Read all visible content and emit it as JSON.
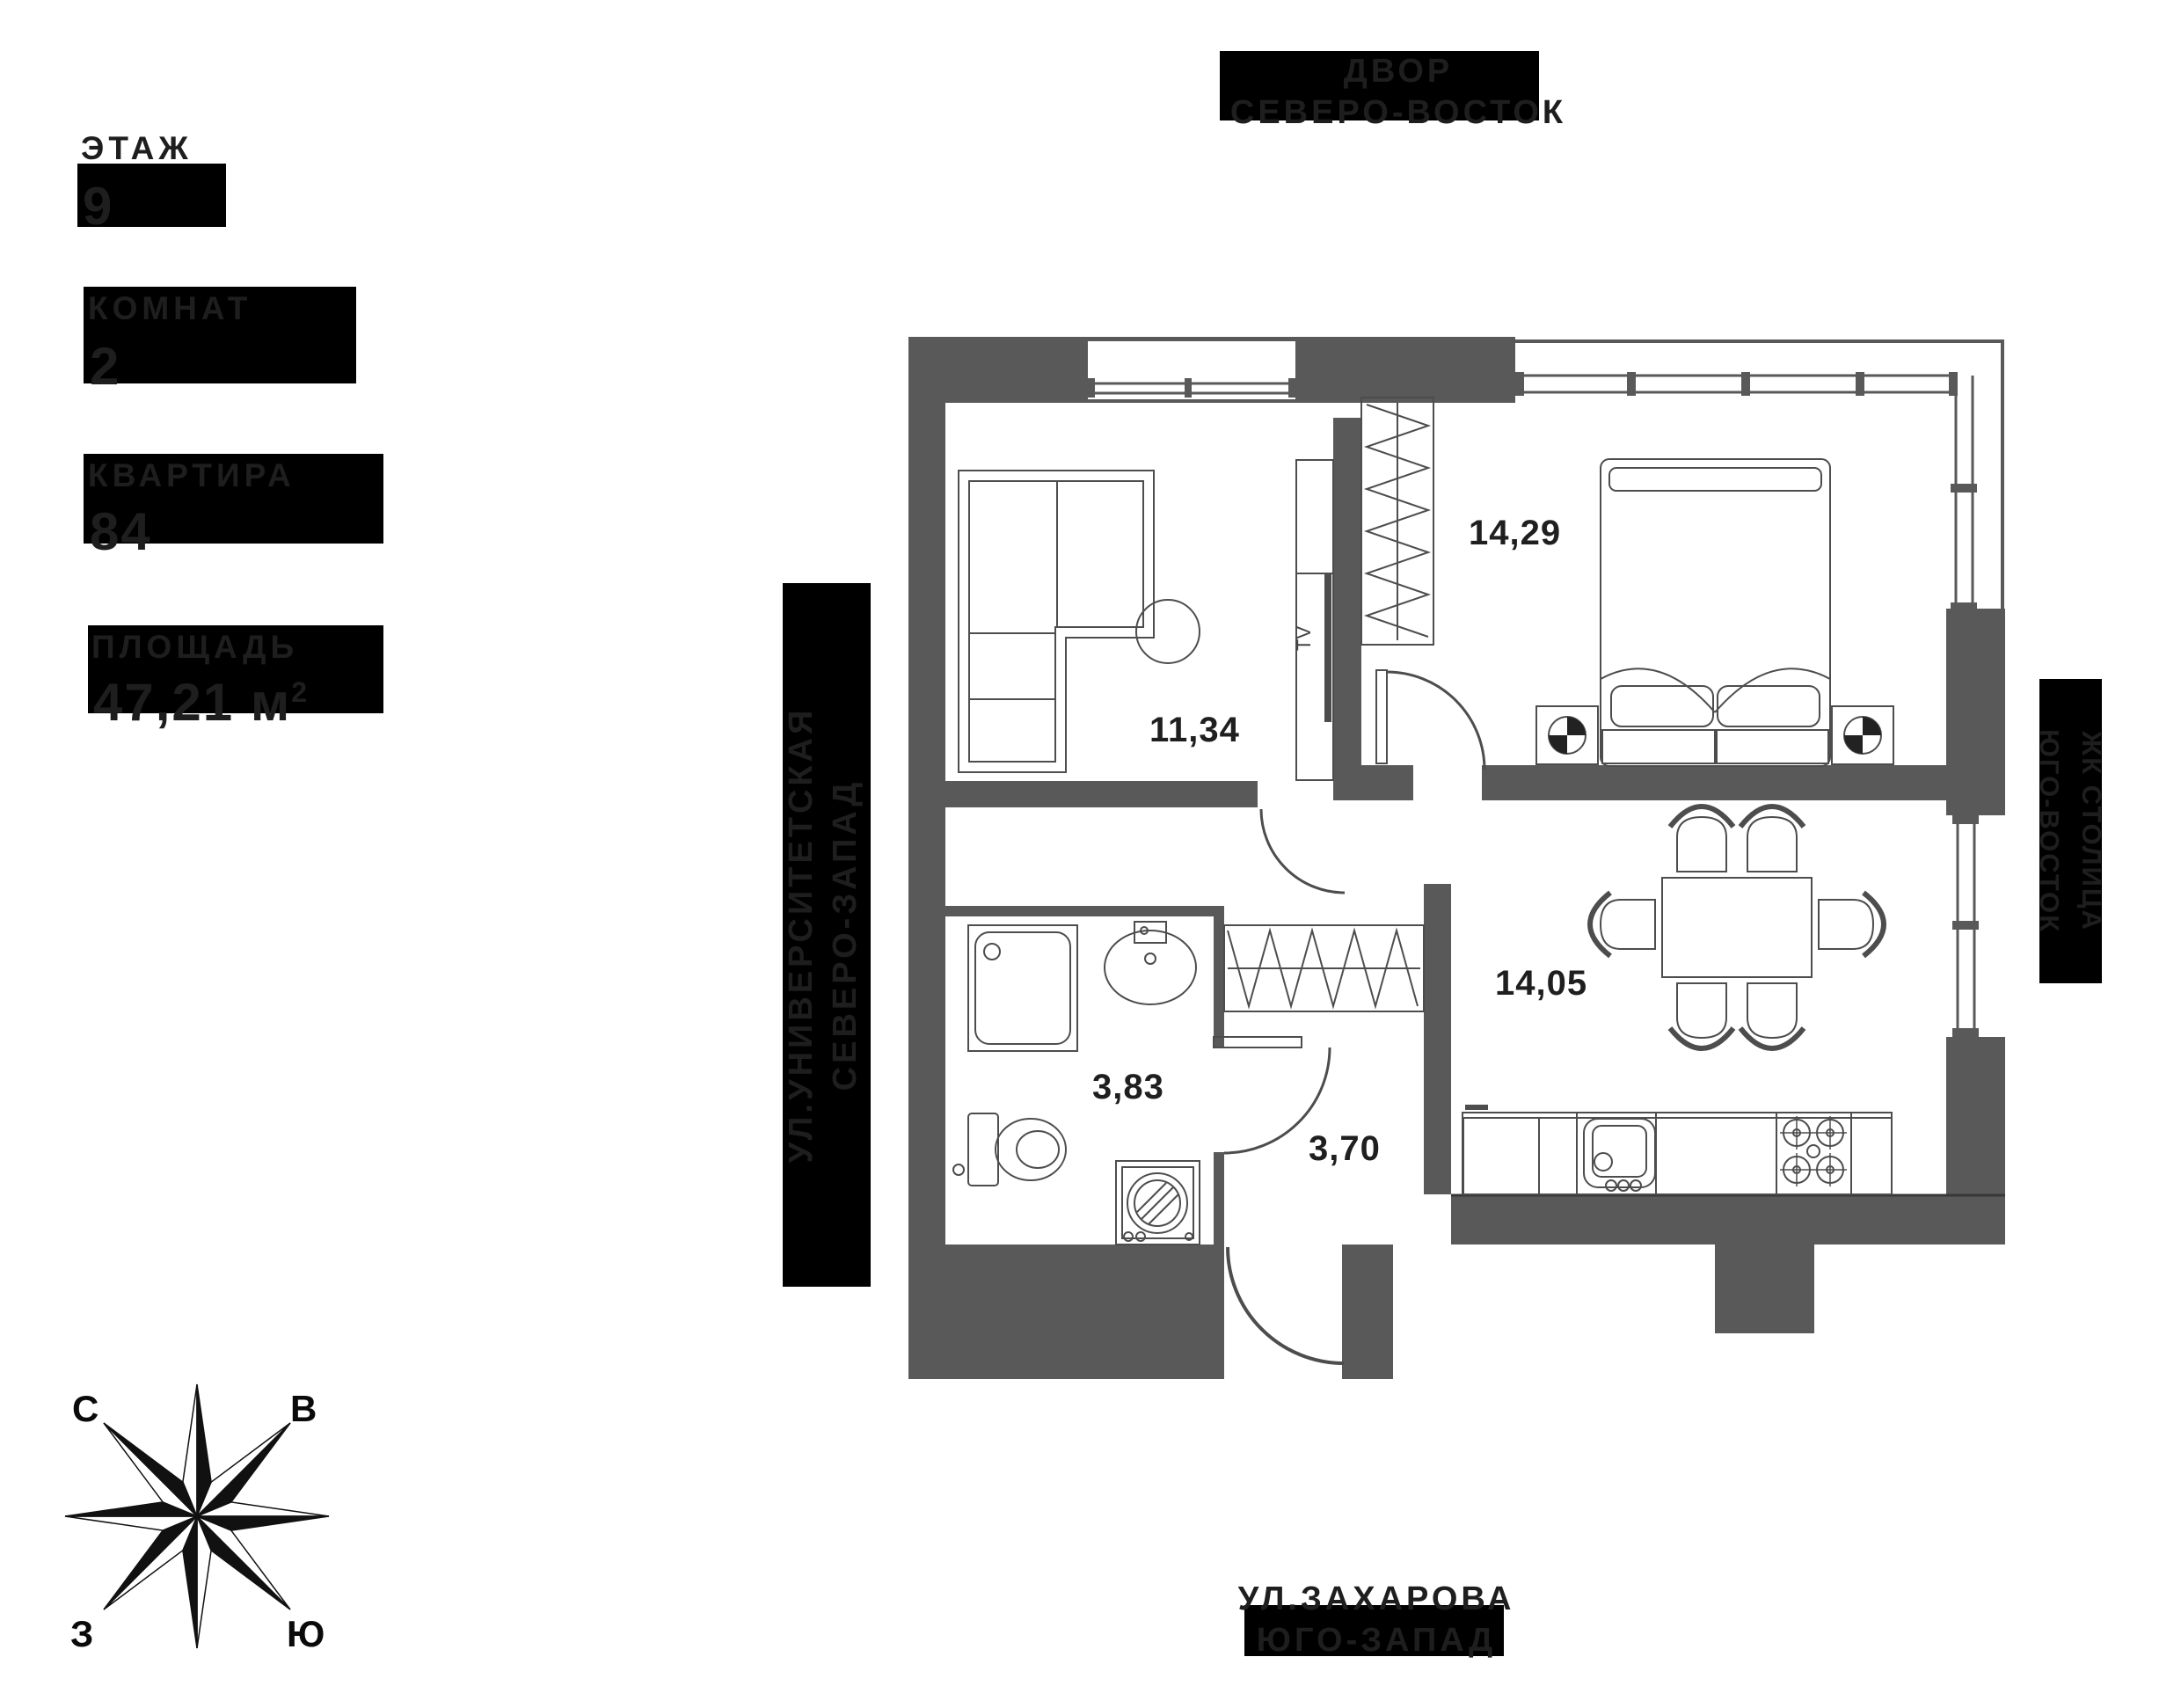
{
  "info_panel": {
    "items": [
      {
        "label": "ЭТАЖ",
        "value": "9"
      },
      {
        "label": "КОМНАТ",
        "value": "2"
      },
      {
        "label": "КВАРТИРА",
        "value": "84"
      },
      {
        "label": "ПЛОЩАДЬ",
        "value": "47,21 м",
        "sup": "2"
      }
    ]
  },
  "direction_labels": {
    "top": {
      "line1": "ДВОР",
      "line2": "СЕВЕРО-ВОСТОК"
    },
    "left": {
      "line1": "УЛ.УНИВЕРСИТЕТСКАЯ",
      "line2": "СЕВЕРО-ЗАПАД"
    },
    "right": {
      "line1": "ЖК СТОЛИЦА",
      "line2": "ЮГО-ВОСТОК"
    },
    "bottom": {
      "line1": "УЛ.ЗАХАРОВА",
      "line2": "ЮГО-ЗАПАД"
    }
  },
  "compass": {
    "north": "С",
    "east": "В",
    "west": "З",
    "south": "Ю"
  },
  "plan": {
    "rooms": [
      {
        "name": "living-room",
        "area": "11,34"
      },
      {
        "name": "bedroom",
        "area": "14,29"
      },
      {
        "name": "kitchen-dining",
        "area": "14,05"
      },
      {
        "name": "bathroom",
        "area": "3,83"
      },
      {
        "name": "hallway",
        "area": "3,70"
      }
    ],
    "tv_label": "TV"
  },
  "colors": {
    "wall": "#595959",
    "label_box": "#000000",
    "dark_text": "#1e1e1e",
    "outline": "#4d4d4d"
  }
}
